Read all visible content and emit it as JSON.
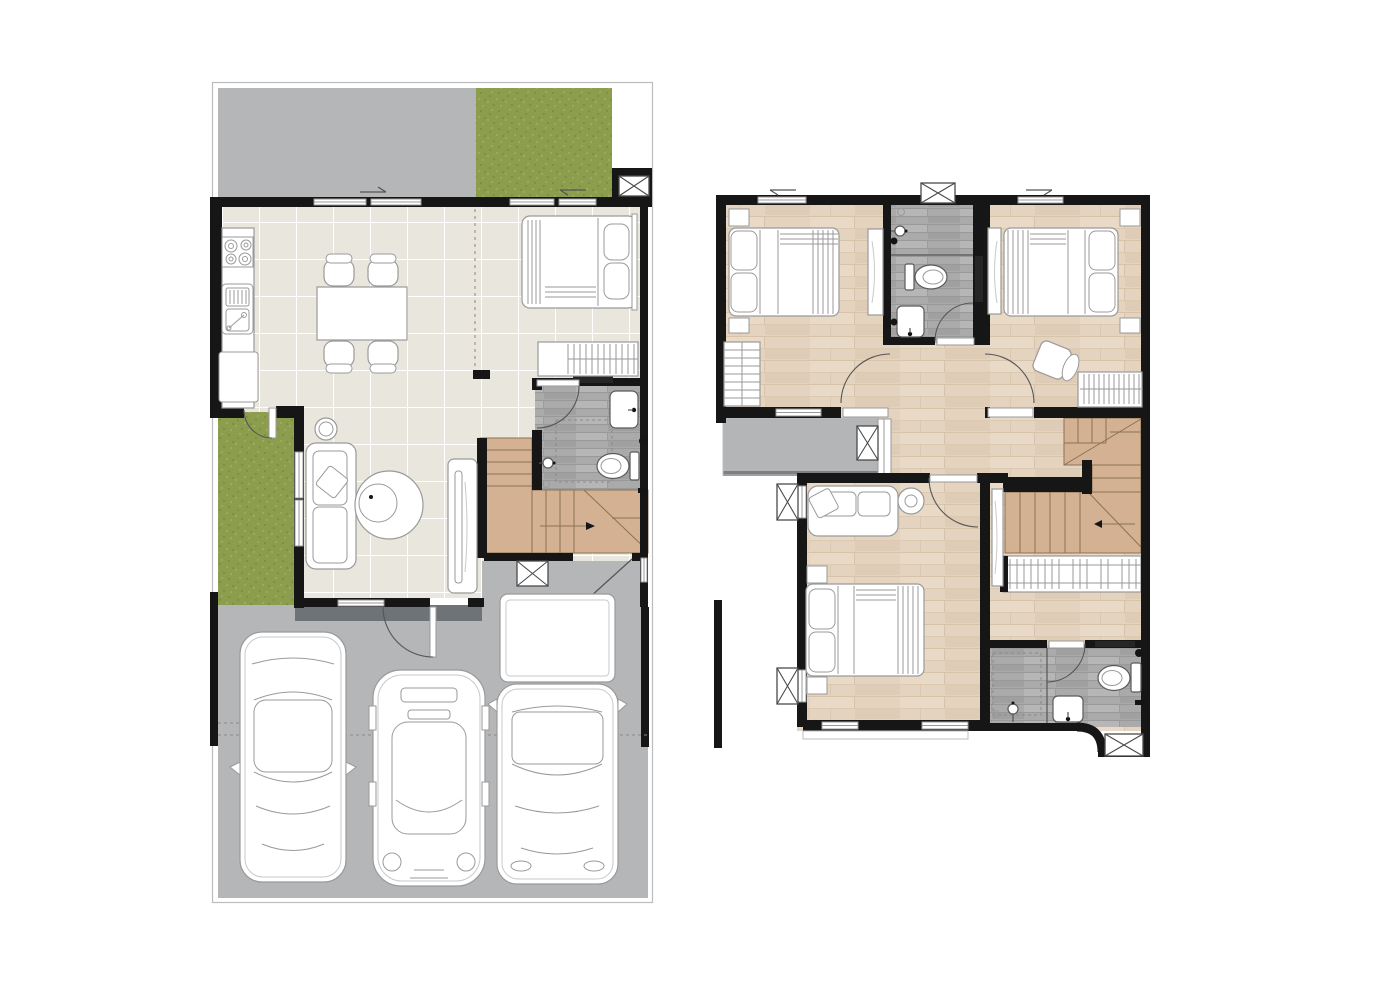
{
  "sheet": {
    "type": "architectural floor plan drawing",
    "width_px": 1375,
    "height_px": 990,
    "background": "#ffffff",
    "visible_text": ""
  },
  "palette": {
    "wall": "#161616",
    "line": "#9a9a9a",
    "line-dark": "#555555",
    "paving": "#b5b6b8",
    "paving-dark": "#6e7377",
    "grass": "#8c9e4e",
    "grass-dark": "#7d9043",
    "grass-light": "#9aab5e",
    "tile": "#e9e6dd",
    "tile-line": "#ffffff",
    "wood": "#e3d3bf",
    "wood-light": "#ecdfcd",
    "wood-dark": "#d7c3aa",
    "gwood": "#aaaaaa",
    "gwood-light": "#bbbbbb",
    "gwood-dark": "#999999",
    "stair": "#d3b192",
    "stair-line": "#8b7254",
    "balcony": "#b3b5b7",
    "balcony-edge": "#7c8083",
    "site-border": "#bcbcbc",
    "niche": "#262626"
  },
  "plans": {
    "ground_floor": {
      "id": "ground-floor-plan",
      "zones": [
        "driveway",
        "front-lawn",
        "kitchen",
        "dining-area",
        "living-area",
        "bedroom",
        "bathroom",
        "staircase",
        "side-garden",
        "entry-porch",
        "carport"
      ],
      "furniture": [
        "kitchen-counter",
        "stove-4-burner",
        "dish-rack",
        "kitchen-sink",
        "lower-cabinet",
        "dining-table",
        "dining-chairs-4",
        "double-bed",
        "wardrobe",
        "sofa",
        "round-rug",
        "coffee-table",
        "side-stool",
        "tv-console",
        "toilet",
        "wash-basin",
        "shower"
      ],
      "vehicles": [
        "sedan",
        "hatchback",
        "pickup-truck"
      ]
    },
    "second_floor": {
      "id": "second-floor-plan",
      "zones": [
        "bedroom-2",
        "shared-bathroom",
        "bedroom-3",
        "hallway",
        "balcony",
        "master-bedroom",
        "master-bathroom",
        "staircase",
        "walk-in-closet"
      ],
      "furniture": [
        "double-bed-bedroom-2",
        "double-bed-bedroom-3",
        "master-double-bed",
        "nightstands",
        "shelf-unit",
        "closet-rail",
        "armchair",
        "sofa",
        "round-table",
        "mirror-panels",
        "stair-railing",
        "toilets-2",
        "wash-basins-2",
        "showers-2"
      ]
    }
  }
}
